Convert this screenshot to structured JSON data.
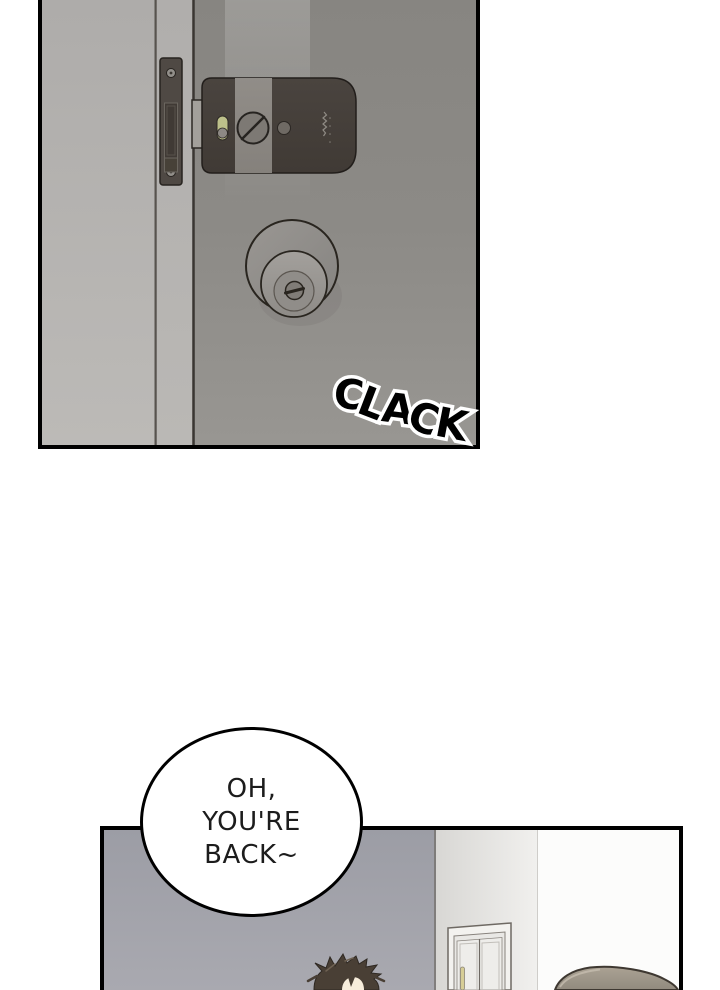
{
  "page": {
    "type": "webtoon-comic-page",
    "background_color": "#ffffff"
  },
  "sound_effect": {
    "word": "CLACK",
    "letters": [
      "C",
      "L",
      "A",
      "C",
      "K"
    ],
    "fill_color": "#000000",
    "outline_color": "#ffffff"
  },
  "speech_bubble": {
    "full_text": "OH, YOU'RE BACK~",
    "lines": [
      "OH,",
      "YOU'RE",
      "BACK~"
    ],
    "bubble_fill": "#ffffff",
    "bubble_stroke": "#000000",
    "text_color": "#1c1c1c"
  },
  "panel_door_closeup": {
    "border_color": "#000000",
    "door_color": "#8c8a86",
    "door_frame_color": "#b4b2af",
    "lock_body_color": "#48423d",
    "lock_band_color": "#8e8a85",
    "lock_indicator_color": "#bdc08a",
    "strike_plate_color": "#4f4944",
    "knob_color": "#969390"
  },
  "panel_room": {
    "border_color": "#000000",
    "wall_color": "#a1a1a9",
    "door_wall_color": "#e9e8e5",
    "inner_door_color": "#efeeeb",
    "door_handle_color": "#d6cd96",
    "front_hair_color": "#493f35",
    "front_skin_color": "#f7eddb",
    "right_head_color": "#9d948a"
  }
}
